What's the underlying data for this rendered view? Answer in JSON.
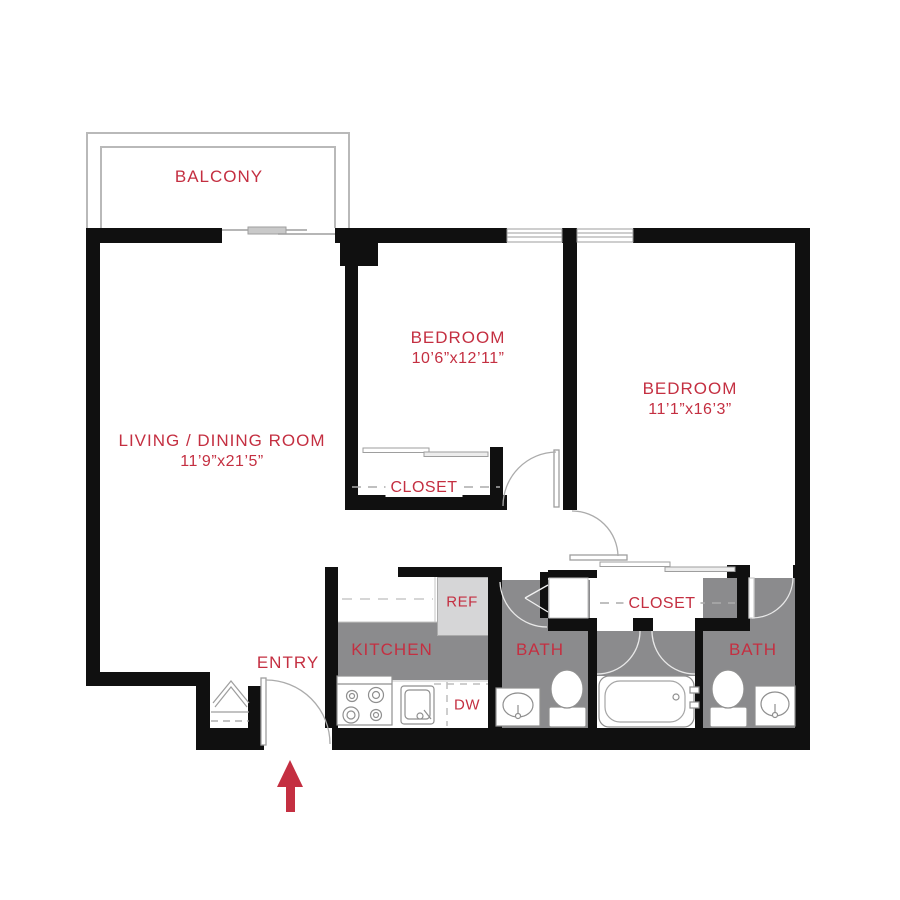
{
  "colors": {
    "accent_red": "#C42F41",
    "wall_black": "#101010",
    "floor_gray": "#8B8B8D",
    "appliance_gray": "#D6D6D7"
  },
  "rooms": {
    "balcony": {
      "label": "BALCONY"
    },
    "living_dining": {
      "label": "LIVING / DINING ROOM",
      "dimensions": "11’9”x21’5”"
    },
    "bedroom_1": {
      "label": "BEDROOM",
      "dimensions": "10’6”x12’11”"
    },
    "bedroom_2": {
      "label": "BEDROOM",
      "dimensions": "11’1”x16’3”"
    },
    "kitchen": {
      "label": "KITCHEN"
    },
    "bath_1": {
      "label": "BATH"
    },
    "bath_2": {
      "label": "BATH"
    },
    "closet_bedroom_1": {
      "label": "CLOSET"
    },
    "closet_bedroom_2": {
      "label": "CLOSET"
    },
    "entry": {
      "label": "ENTRY"
    }
  },
  "appliances": {
    "refrigerator_label": "REF",
    "dishwasher_label": "DW"
  }
}
